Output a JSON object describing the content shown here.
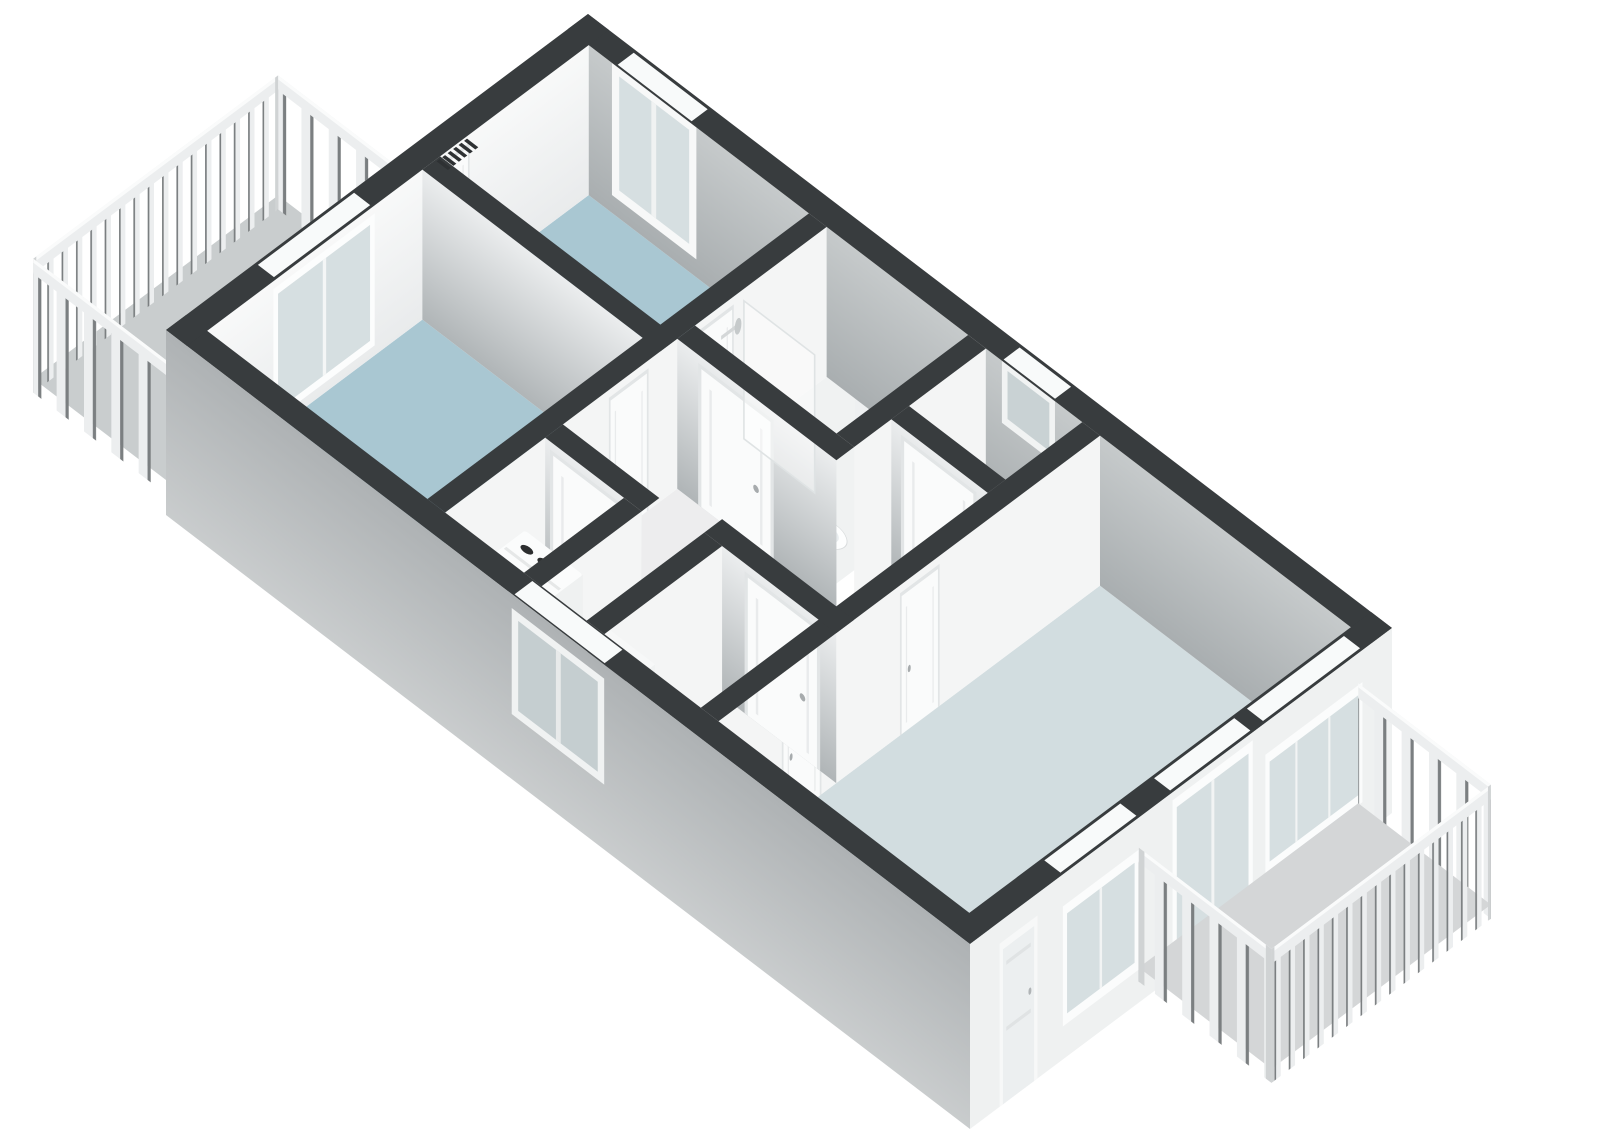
{
  "scene": {
    "kind": "isometric-3d-floorplan-render",
    "background": "#ffffff",
    "colors": {
      "wall_top": "#383c3e",
      "wall_face_light": "#f4f5f5",
      "floor_bedroom": "#a9c7d2",
      "floor_living": "#d2dde0",
      "floor_bathroom": "#f0f2f2",
      "floor_hall": "#ededee",
      "floor_wc": "#eef0f0",
      "floor_closet": "#eef0f0",
      "floor_kitchen": "#eaeced",
      "floor_entry": "#e7e9e9",
      "floor_balcony_nw": "#c9cdce",
      "floor_balcony_se": "#d4d6d7",
      "facade_se": "#eff1f1",
      "window_glass": "#d6dfe1",
      "window_frame": "#fbfcfc",
      "shower_tray": "#47a7d8",
      "shower_tray_inner": "#74bfe4",
      "cooktop": "#26292a",
      "railing_light": "#eceeef",
      "washer_body": "#fbfcfc",
      "accent_stair_rail": "#9b5b4a",
      "band_inset": "#f8fafa",
      "step_shades": [
        "#e3e5e5",
        "#d6d8d8",
        "#c7c9c9",
        "#b7b9b9",
        "#a6a8a8"
      ]
    },
    "rooms": [
      {
        "id": "bedroom-1",
        "floor": "blue"
      },
      {
        "id": "bedroom-2",
        "floor": "blue"
      },
      {
        "id": "bathroom",
        "fixtures": [
          "shower",
          "glass-screen",
          "washbasin",
          "toilet"
        ]
      },
      {
        "id": "wc-room",
        "fixtures": []
      },
      {
        "id": "hallway",
        "fixtures": []
      },
      {
        "id": "closet",
        "fixtures": [
          "washing-machine"
        ]
      },
      {
        "id": "kitchen",
        "fixtures": [
          "counter",
          "cooktop"
        ]
      },
      {
        "id": "entry-hall",
        "fixtures": [
          "staircase-down"
        ]
      },
      {
        "id": "living-room",
        "fixtures": []
      }
    ],
    "balconies": [
      {
        "id": "balcony-northwest",
        "railing": "vertical-slats"
      },
      {
        "id": "balcony-southeast",
        "railing": "vertical-slats"
      }
    ]
  }
}
